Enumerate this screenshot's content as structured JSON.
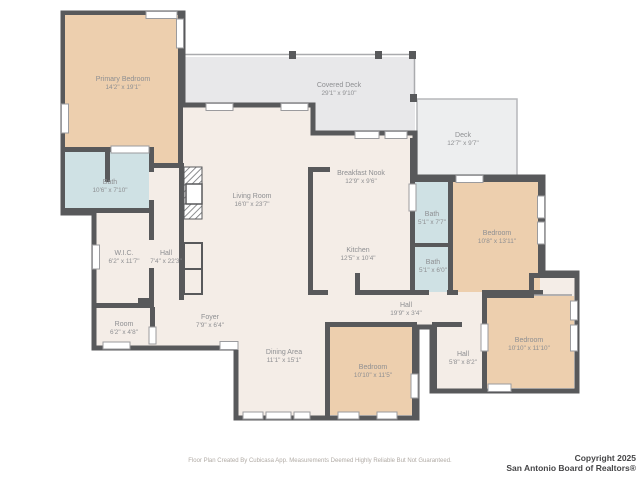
{
  "title": "Residential floor plan",
  "rooms": [
    {
      "id": "primary-bedroom",
      "name": "Primary Bedroom",
      "dims": "14'2\" x 19'1\""
    },
    {
      "id": "bath-main",
      "name": "Bath",
      "dims": "10'6\" x 7'10\""
    },
    {
      "id": "wic",
      "name": "W.I.C.",
      "dims": "6'2\" x 11'7\""
    },
    {
      "id": "hall-west",
      "name": "Hall",
      "dims": "7'4\" x 22'3\""
    },
    {
      "id": "room",
      "name": "Room",
      "dims": "6'2\" x 4'8\""
    },
    {
      "id": "foyer",
      "name": "Foyer",
      "dims": "7'9\" x 6'4\""
    },
    {
      "id": "living-room",
      "name": "Living Room",
      "dims": "16'0\" x 23'7\""
    },
    {
      "id": "covered-deck",
      "name": "Covered Deck",
      "dims": "29'1\" x 9'10\""
    },
    {
      "id": "deck",
      "name": "Deck",
      "dims": "12'7\" x 9'7\""
    },
    {
      "id": "breakfast-nook",
      "name": "Breakfast Nook",
      "dims": "12'9\" x 9'6\""
    },
    {
      "id": "kitchen",
      "name": "Kitchen",
      "dims": "12'5\" x 10'4\""
    },
    {
      "id": "bath-upper",
      "name": "Bath",
      "dims": "5'1\" x 7'7\""
    },
    {
      "id": "bath-lower",
      "name": "Bath",
      "dims": "5'1\" x 6'0\""
    },
    {
      "id": "bedroom-east",
      "name": "Bedroom",
      "dims": "10'8\" x 13'11\""
    },
    {
      "id": "hall-center",
      "name": "Hall",
      "dims": "19'9\" x 3'4\""
    },
    {
      "id": "dining-area",
      "name": "Dining Area",
      "dims": "11'1\" x 15'1\""
    },
    {
      "id": "bedroom-south",
      "name": "Bedroom",
      "dims": "10'10\" x 11'5\""
    },
    {
      "id": "hall-south",
      "name": "Hall",
      "dims": "5'8\" x 8'2\""
    },
    {
      "id": "bedroom-southeast",
      "name": "Bedroom",
      "dims": "10'10\" x 11'10\""
    }
  ],
  "footer": {
    "disclaimer": "Floor Plan Created By Cubicasa App. Measurements Deemed Highly Reliable But Not Guaranteed.",
    "copyright_line1": "Copyright 2025",
    "copyright_line2": "San Antonio Board of Realtors®"
  },
  "colors": {
    "wall": "#58595b",
    "floor_cream": "#f4ede7",
    "bedroom_peach": "#edcfae",
    "bath_blue": "#cfe1e4",
    "deck_gray": "#e8e8ea"
  }
}
